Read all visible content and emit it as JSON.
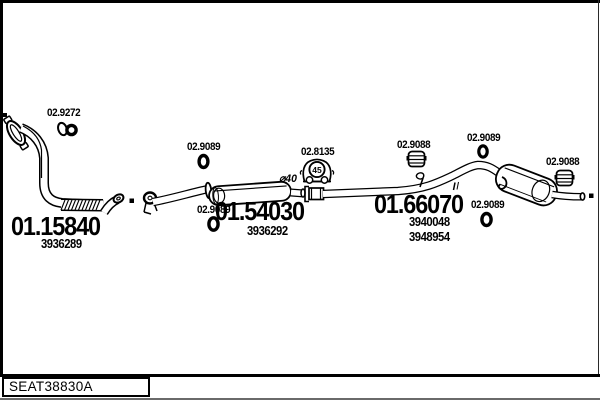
{
  "diagram": {
    "title_block": {
      "code": "SEAT38830A"
    },
    "parts": {
      "front_pipe": {
        "number": "01.15840",
        "ref": "3936289"
      },
      "center_muffler": {
        "number": "01.54030",
        "ref": "3936292"
      },
      "rear_silencer": {
        "number": "01.66070",
        "ref_a": "3940048",
        "ref_b": "3948954"
      }
    },
    "hardware": {
      "clamp": {
        "code": "02.9272"
      },
      "rings": [
        {
          "code": "02.9089"
        },
        {
          "code": "02.9089"
        },
        {
          "code": "02.9089"
        },
        {
          "code": "02.9089"
        }
      ],
      "bracket": {
        "code": "02.8135",
        "badge": "45"
      },
      "mounts": [
        {
          "code": "02.9088"
        },
        {
          "code": "02.9088"
        }
      ]
    },
    "annotations": {
      "pipe_diameter": "⌀40"
    }
  }
}
